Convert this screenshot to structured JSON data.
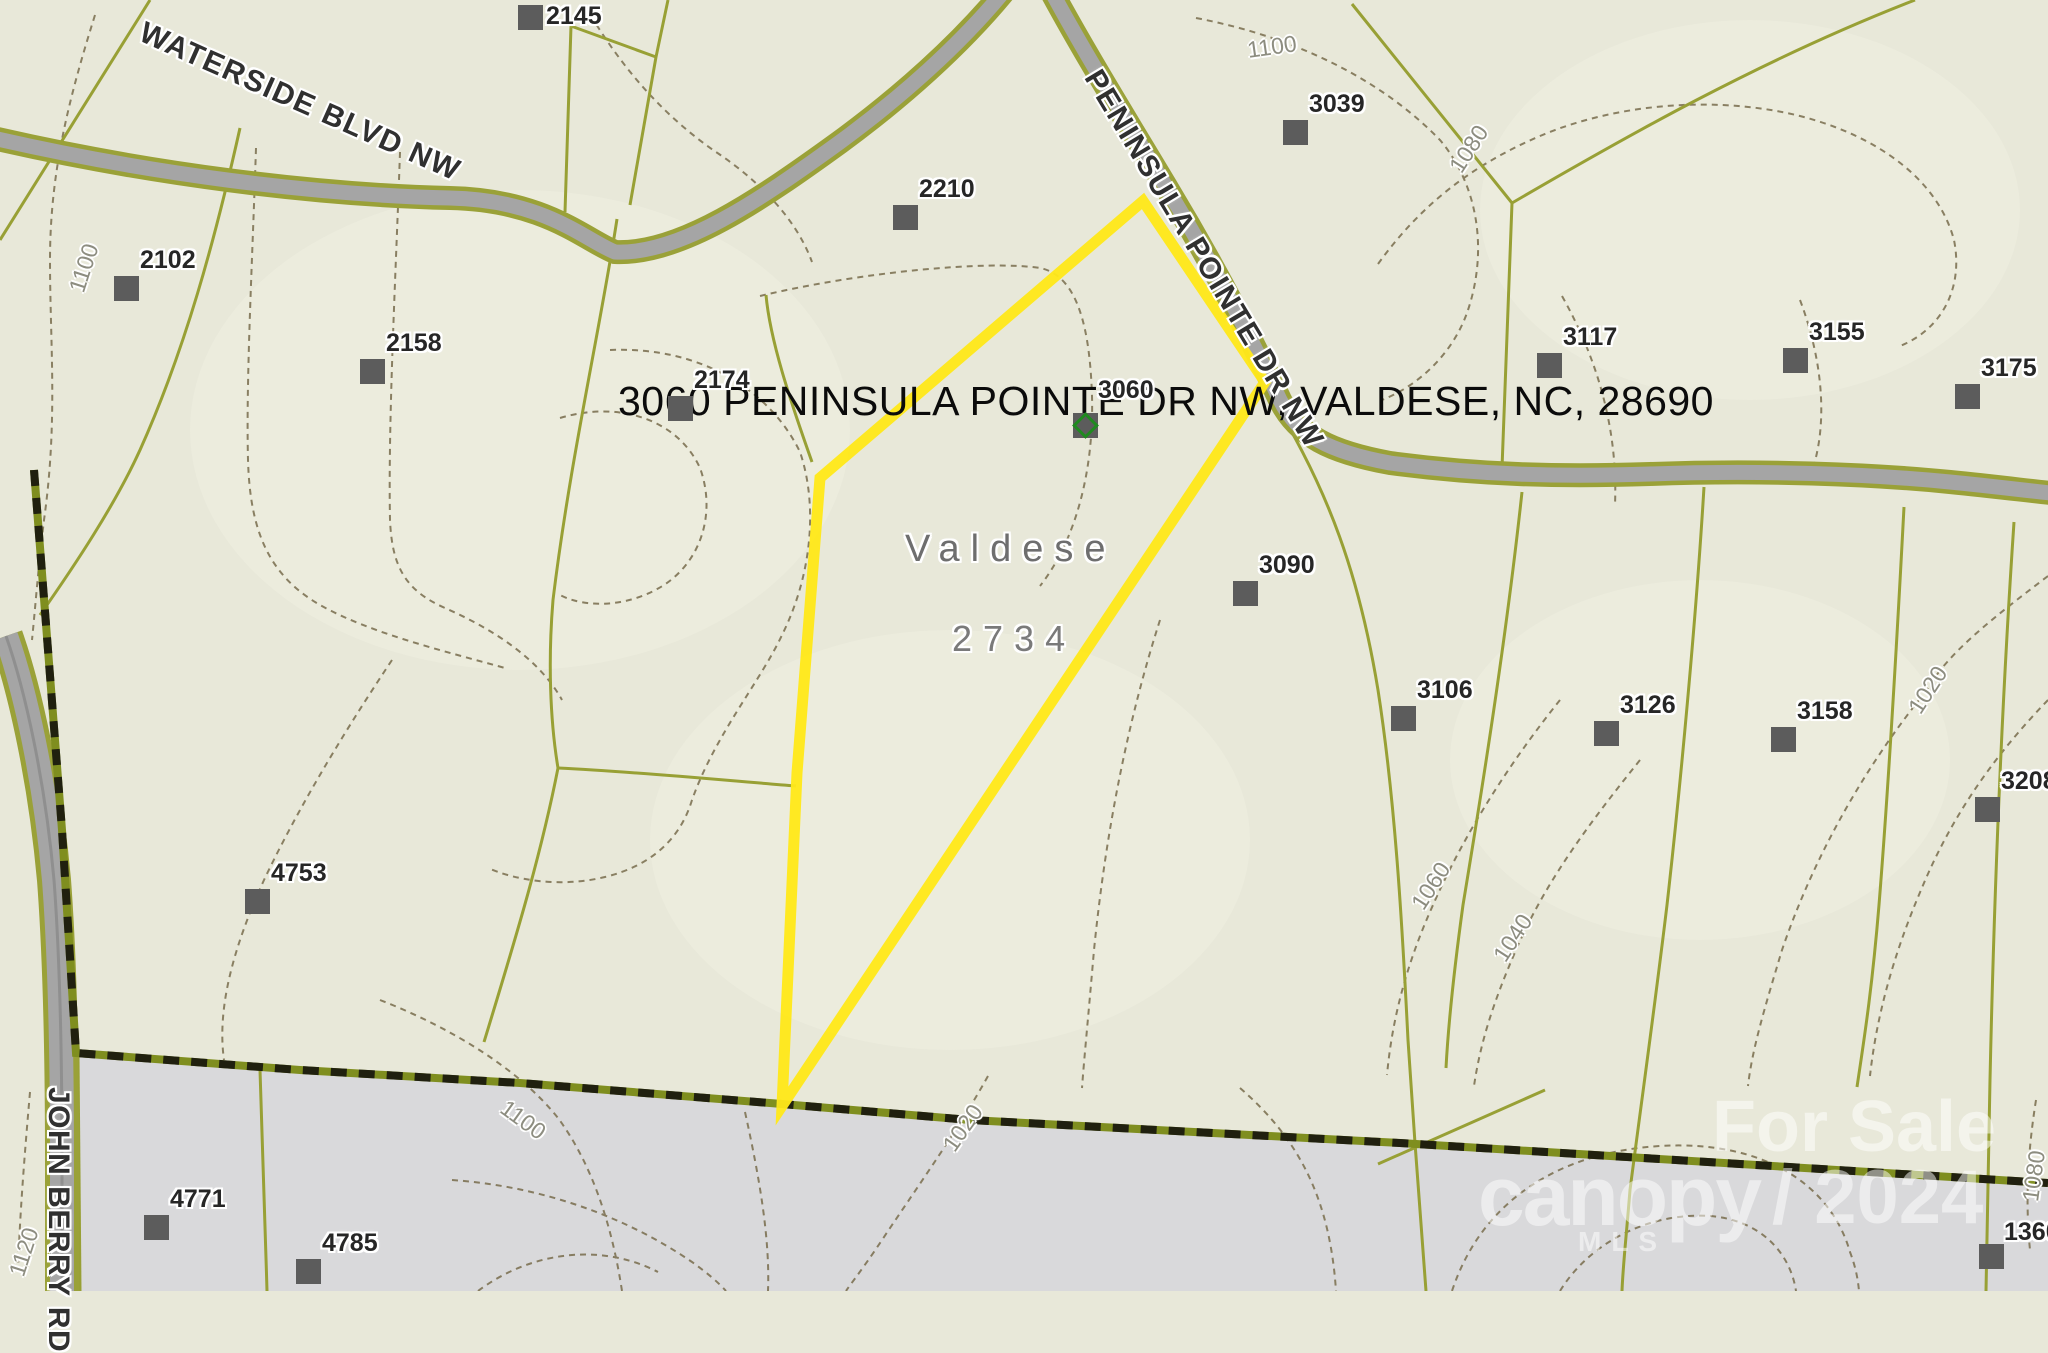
{
  "map": {
    "title": "3060 PENINSULA POINTE DR NW, VALDESE, NC, 28690",
    "municipality_label": "Valdese",
    "township_number": "2734",
    "highlighted_parcel": "3060",
    "watermark": {
      "line1": "For Sale",
      "line2": "canopy",
      "line3": "/ 2024",
      "line4": "MLS"
    },
    "streets": [
      {
        "name": "WATERSIDE BLVD NW",
        "x": 148,
        "y": 16,
        "rot": 24
      },
      {
        "name": "PENINSULA POINTE DR NW",
        "x": 1106,
        "y": 64,
        "rot": 59
      },
      {
        "name": "JOHN BERRY RD",
        "x": 75,
        "y": 1087,
        "rot": 90
      }
    ],
    "parcels": [
      {
        "label": "2145",
        "x": 518,
        "y": 5,
        "lx": 546,
        "ly": 2
      },
      {
        "label": "2102",
        "x": 114,
        "y": 276
      },
      {
        "label": "2158",
        "x": 360,
        "y": 359
      },
      {
        "label": "2174",
        "x": 668,
        "y": 396
      },
      {
        "label": "2210",
        "x": 893,
        "y": 205
      },
      {
        "label": "3039",
        "x": 1283,
        "y": 120
      },
      {
        "label": "3060",
        "x": 1073,
        "y": 413,
        "lx": 1098,
        "ly": 376,
        "green": true
      },
      {
        "label": "3090",
        "x": 1233,
        "y": 581
      },
      {
        "label": "3117",
        "x": 1537,
        "y": 353
      },
      {
        "label": "3155",
        "x": 1783,
        "y": 348
      },
      {
        "label": "3175",
        "x": 1955,
        "y": 384
      },
      {
        "label": "3106",
        "x": 1391,
        "y": 706
      },
      {
        "label": "3126",
        "x": 1594,
        "y": 721
      },
      {
        "label": "3158",
        "x": 1771,
        "y": 727
      },
      {
        "label": "3208",
        "x": 1975,
        "y": 797
      },
      {
        "label": "4753",
        "x": 245,
        "y": 889
      },
      {
        "label": "4771",
        "x": 144,
        "y": 1215
      },
      {
        "label": "4785",
        "x": 296,
        "y": 1259
      },
      {
        "label": "1360",
        "x": 1979,
        "y": 1244,
        "lx": 2004,
        "ly": 1218
      }
    ],
    "contour_labels": [
      {
        "text": "1100",
        "x": 84,
        "y": 268,
        "rot": -72
      },
      {
        "text": "1100",
        "x": 1272,
        "y": 47,
        "rot": -8
      },
      {
        "text": "1080",
        "x": 1469,
        "y": 149,
        "rot": -57
      },
      {
        "text": "1020",
        "x": 1928,
        "y": 690,
        "rot": -57
      },
      {
        "text": "1060",
        "x": 1431,
        "y": 886,
        "rot": -57
      },
      {
        "text": "1040",
        "x": 1513,
        "y": 938,
        "rot": -57
      },
      {
        "text": "1120",
        "x": 24,
        "y": 1252,
        "rot": -72
      },
      {
        "text": "1100",
        "x": 523,
        "y": 1120,
        "rot": 36
      },
      {
        "text": "1020",
        "x": 963,
        "y": 1128,
        "rot": -55
      },
      {
        "text": "1080",
        "x": 2034,
        "y": 1176,
        "rot": -82
      }
    ],
    "colors": {
      "beige": "#e8e8d9",
      "beige_light": "#f0f0e1",
      "gray_region": "#d9d9db",
      "parcel_line": "#98a035",
      "road_fill": "#a5a5a5",
      "road_casing": "#9aa138",
      "road_center": "#8f8f8f",
      "contour": "#7e7354",
      "boundary_olive": "#7f8e1f",
      "boundary_black": "#20200f",
      "highlight": "#ffe81a",
      "marker": "#5c5c5c",
      "marker_green": "#1f8a1f",
      "label": "#262626",
      "street_label": "#303030",
      "contour_label": "#8d8d80",
      "region_label": "#6e6e6e",
      "watermark": "rgba(255,255,255,0.5)"
    }
  }
}
